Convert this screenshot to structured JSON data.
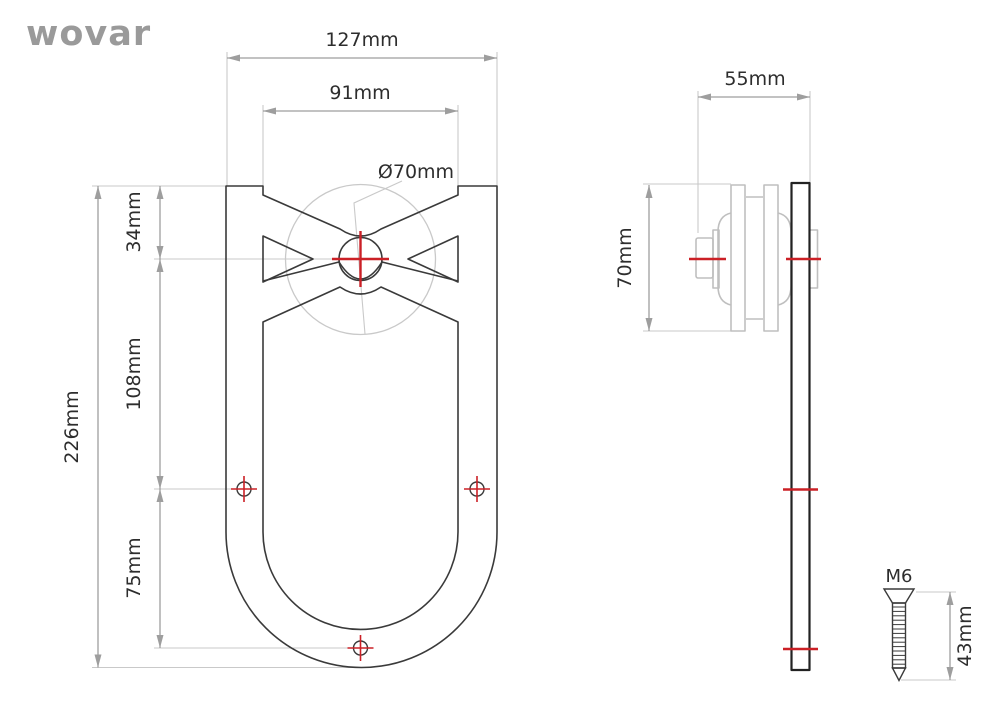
{
  "brand": {
    "logo_text": "wovar"
  },
  "front_view": {
    "dim_width": "127mm",
    "dim_notch_width": "91mm",
    "dim_wheel_diameter": "Ø70mm",
    "dim_total_height": "226mm",
    "dim_top_to_axle": "34mm",
    "dim_axle_to_mount_holes": "108mm",
    "dim_mount_holes_to_bottom_hole": "75mm"
  },
  "side_view": {
    "dim_depth": "55mm",
    "dim_wheel_height": "70mm"
  },
  "screw_detail": {
    "label_thread": "M6",
    "dim_length": "43mm"
  },
  "colors": {
    "outline": "#3a3a3a",
    "strap": "#222222",
    "spool": "#bfbfbf",
    "light": "#c9c9c9",
    "dim": "#9e9e9e",
    "red": "#cb2026",
    "text": "#2d2d2d",
    "logo": "#9a9a9a"
  }
}
